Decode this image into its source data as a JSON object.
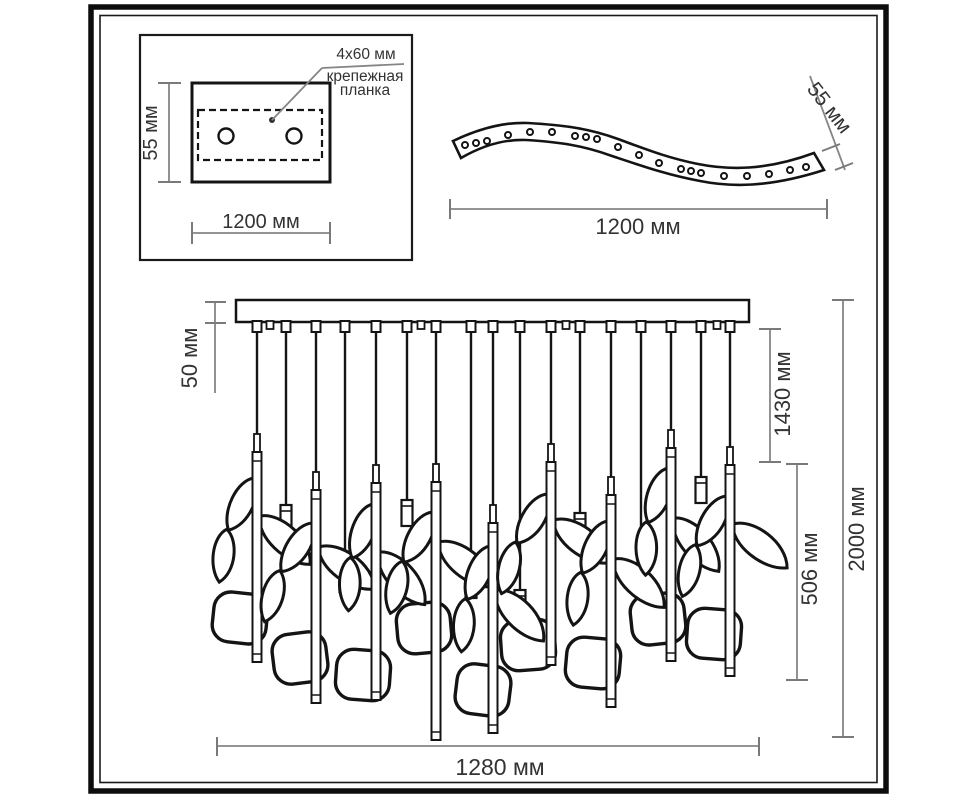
{
  "mounting_plate_inset": {
    "callout_size": "4x60 мм",
    "callout_name_line1": "крепежная",
    "callout_name_line2": "планка",
    "height_dimension": "55 мм",
    "width_dimension": "1200 мм"
  },
  "curved_strip": {
    "thickness_dimension": "55 мм",
    "length_dimension": "1200 мм"
  },
  "chandelier": {
    "canopy_thickness_dimension": "50 мм",
    "upper_drop_dimension": "1430 мм",
    "lamp_section_dimension": "506 мм",
    "total_height_dimension": "2000 мм",
    "total_width_dimension": "1280 мм"
  }
}
